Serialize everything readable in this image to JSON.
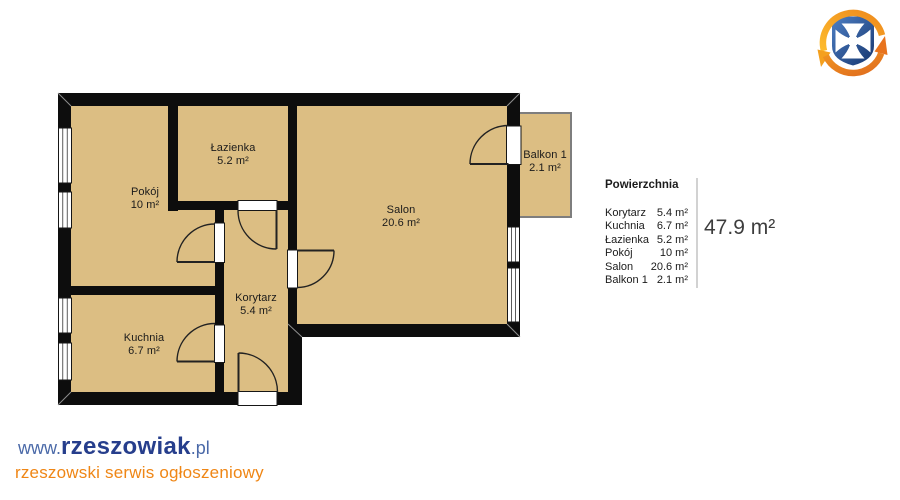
{
  "floorplan": {
    "rooms": [
      {
        "id": "pokoj",
        "label": "Pokój",
        "area": "10 m²"
      },
      {
        "id": "lazienka",
        "label": "Łazienka",
        "area": "5.2 m²"
      },
      {
        "id": "salon",
        "label": "Salon",
        "area": "20.6 m²"
      },
      {
        "id": "kuchnia",
        "label": "Kuchnia",
        "area": "6.7 m²"
      },
      {
        "id": "korytarz",
        "label": "Korytarz",
        "area": "5.4 m²"
      },
      {
        "id": "balkon",
        "label": "Balkon 1",
        "area": "2.1 m²"
      }
    ]
  },
  "legend": {
    "title": "Powierzchnia",
    "rows": [
      {
        "label": "Korytarz",
        "value": "5.4 m²"
      },
      {
        "label": "Kuchnia",
        "value": "6.7 m²"
      },
      {
        "label": "Łazienka",
        "value": "5.2 m²"
      },
      {
        "label": "Pokój",
        "value": "10 m²"
      },
      {
        "label": "Salon",
        "value": "20.6 m²"
      },
      {
        "label": "Balkon 1",
        "value": "2.1 m²"
      }
    ],
    "total": "47.9 m²"
  },
  "branding": {
    "www": "www.",
    "name": "rzeszowiak",
    "tld": ".pl",
    "tagline": "rzeszowski serwis ogłoszeniowy"
  },
  "colors": {
    "floor": "#dcbe83",
    "wall": "#0d0d0d",
    "balcony_border": "#7e7e7e",
    "brand_navy": "#263e8c",
    "brand_blue": "#4a69a8",
    "brand_orange": "#ef8615",
    "logo_blue_dark": "#16366f",
    "logo_blue_light": "#4e7fc4",
    "logo_yellow": "#fdbb2d",
    "logo_orange": "#e8731d"
  }
}
